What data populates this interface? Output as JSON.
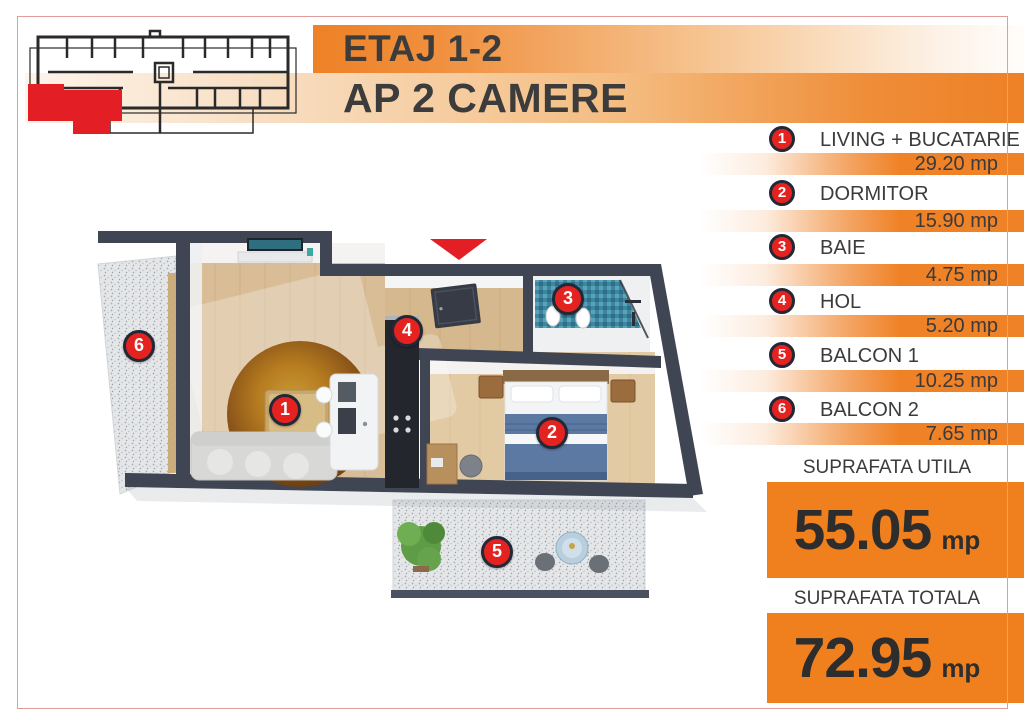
{
  "header": {
    "floor": "ETAJ 1-2",
    "apartment": "AP 2 CAMERE"
  },
  "legend": {
    "items": [
      {
        "num": "1",
        "name": "LIVING + BUCATARIE",
        "area": "29.20 mp"
      },
      {
        "num": "2",
        "name": "DORMITOR",
        "area": "15.90 mp"
      },
      {
        "num": "3",
        "name": "BAIE",
        "area": "4.75 mp"
      },
      {
        "num": "4",
        "name": "HOL",
        "area": "5.20 mp"
      },
      {
        "num": "5",
        "name": "BALCON 1",
        "area": "10.25 mp"
      },
      {
        "num": "6",
        "name": "BALCON 2",
        "area": "7.65 mp"
      }
    ]
  },
  "totals": {
    "useful": {
      "label": "SUPRAFATA UTILA",
      "value": "55.05",
      "unit": "mp"
    },
    "total": {
      "label": "SUPRAFATA TOTALA",
      "value": "72.95",
      "unit": "mp"
    }
  },
  "plan": {
    "markers": [
      {
        "num": "1"
      },
      {
        "num": "2"
      },
      {
        "num": "3"
      },
      {
        "num": "4"
      },
      {
        "num": "5"
      },
      {
        "num": "6"
      }
    ]
  },
  "colors": {
    "accent_orange": "#ef8126",
    "badge_red": "#e42320",
    "wall_dark": "#3f4552",
    "frame_pink": "#e29c9c",
    "arrow_red": "#e31e24"
  }
}
